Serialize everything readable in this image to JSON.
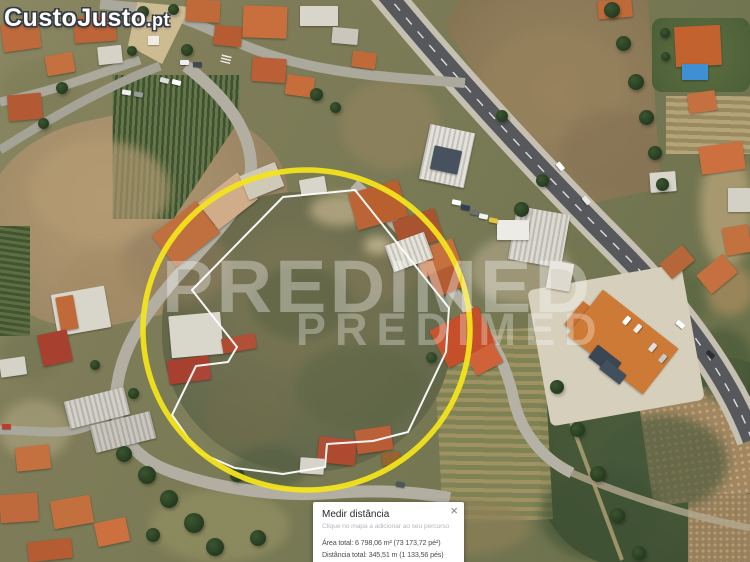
{
  "watermarks": {
    "site_logo_main": "CustoJusto",
    "site_logo_tld": ".pt",
    "brand_large": "PREDIMED",
    "brand_small": "PREDIMED"
  },
  "measure_panel": {
    "title": "Medir distância",
    "hint": "Clique no mapa a adicionar ao seu percurso",
    "area_label": "Área total:",
    "area_value": "6 798,06 m² (73 173,72 pé²)",
    "distance_label": "Distância total:",
    "distance_value": "345,51 m (1 133,56 pés)",
    "close_icon": "×"
  },
  "colors": {
    "highlight_circle": "#f2e41c",
    "parcel_outline": "#ffffff",
    "panel_background": "#ffffff",
    "pool_blue": "#3f8fd4",
    "roof_orange": "#c4713f",
    "highway_asphalt": "#56585c"
  }
}
